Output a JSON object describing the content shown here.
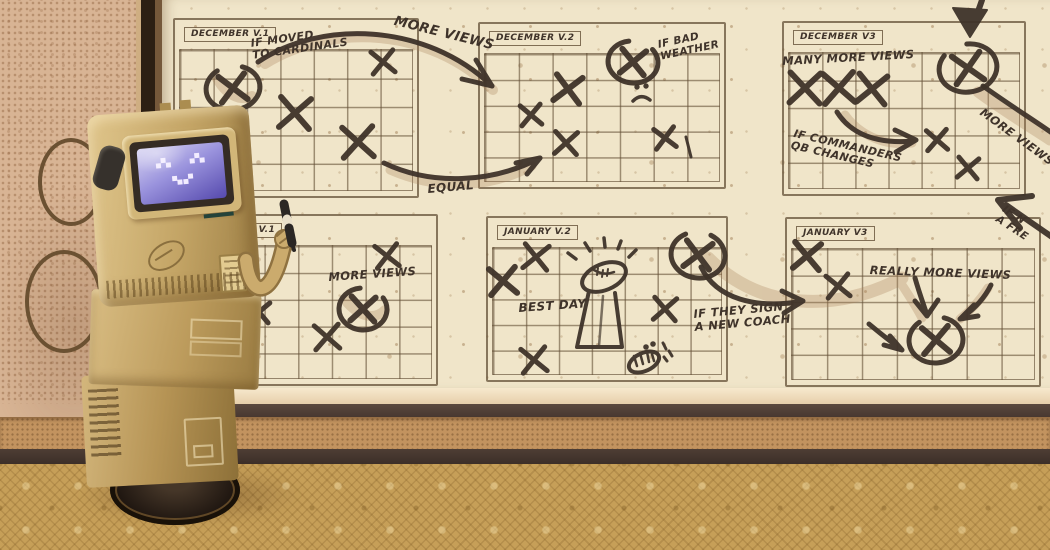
{
  "board": {
    "calendars": [
      {
        "id": "dec-v1",
        "title": "DECEMBER V.1"
      },
      {
        "id": "dec-v2",
        "title": "DECEMBER V.2"
      },
      {
        "id": "dec-v3",
        "title": "DECEMBER V3"
      },
      {
        "id": "jan-v1",
        "title": "JANUARY V.1"
      },
      {
        "id": "jan-v2",
        "title": "JANUARY V.2"
      },
      {
        "id": "jan-v3",
        "title": "JANUARY V3"
      }
    ],
    "annotations": {
      "if_moved": {
        "lines": [
          "IF MOVED",
          "TO CARDINALS"
        ]
      },
      "more_views_top": {
        "lines": [
          "MORE VIEWS"
        ]
      },
      "equal": {
        "lines": [
          "EQUAL"
        ]
      },
      "if_bad_weather": {
        "lines": [
          "IF BAD",
          "WEATHER"
        ]
      },
      "many_more_views": {
        "lines": [
          "MANY MORE VIEWS"
        ]
      },
      "if_commanders": {
        "lines": [
          "IF COMMANDERS",
          "QB CHANGES"
        ]
      },
      "more_views_right_partial": {
        "lines": [
          "MORE VIEWS"
        ]
      },
      "if_free_partial": {
        "lines": [
          "IF N",
          "A FRE"
        ]
      },
      "more_views_jan1": {
        "lines": [
          "MORE VIEWS"
        ]
      },
      "best_day": {
        "lines": [
          "BEST DAY"
        ]
      },
      "if_they_sign": {
        "lines": [
          "IF THEY SIGN",
          "A NEW COACH"
        ]
      },
      "really_more_views": {
        "lines": [
          "REALLY MORE VIEWS"
        ]
      }
    },
    "drawings": [
      "sad-face",
      "football-spotlight",
      "laughing-mouth",
      "x-marks",
      "circled-x-marks",
      "arrows"
    ]
  },
  "marks": {
    "x": [
      {
        "x": 383,
        "y": 62,
        "s": 11,
        "r": -6
      },
      {
        "x": 295,
        "y": 113,
        "s": 15,
        "r": 4
      },
      {
        "x": 358,
        "y": 142,
        "s": 15,
        "r": -3
      },
      {
        "x": 568,
        "y": 89,
        "s": 13,
        "r": 8
      },
      {
        "x": 531,
        "y": 115,
        "s": 10,
        "r": -5
      },
      {
        "x": 566,
        "y": 143,
        "s": 11,
        "r": 3
      },
      {
        "x": 665,
        "y": 138,
        "s": 10,
        "r": -8
      },
      {
        "x": 805,
        "y": 88,
        "s": 15,
        "r": 2
      },
      {
        "x": 839,
        "y": 88,
        "s": 15,
        "r": -4
      },
      {
        "x": 872,
        "y": 89,
        "s": 14,
        "r": 6
      },
      {
        "x": 937,
        "y": 140,
        "s": 10,
        "r": -4
      },
      {
        "x": 968,
        "y": 168,
        "s": 10,
        "r": 5
      },
      {
        "x": 387,
        "y": 256,
        "s": 11,
        "r": -7
      },
      {
        "x": 259,
        "y": 312,
        "s": 10,
        "r": 5
      },
      {
        "x": 327,
        "y": 337,
        "s": 12,
        "r": -4
      },
      {
        "x": 536,
        "y": 257,
        "s": 12,
        "r": 6
      },
      {
        "x": 503,
        "y": 281,
        "s": 13,
        "r": -5
      },
      {
        "x": 665,
        "y": 309,
        "s": 11,
        "r": 4
      },
      {
        "x": 534,
        "y": 360,
        "s": 12,
        "r": -6
      },
      {
        "x": 807,
        "y": 256,
        "s": 13,
        "r": 5
      },
      {
        "x": 838,
        "y": 286,
        "s": 11,
        "r": -6
      }
    ],
    "circled_x": [
      {
        "x": 233,
        "y": 88,
        "s": 13,
        "r": -8,
        "rx": 27,
        "ry": 22
      },
      {
        "x": 633,
        "y": 62,
        "s": 12,
        "r": 6,
        "rx": 25,
        "ry": 21
      },
      {
        "x": 968,
        "y": 68,
        "s": 14,
        "r": -10,
        "rx": 29,
        "ry": 24
      },
      {
        "x": 363,
        "y": 309,
        "s": 12,
        "r": 3,
        "rx": 24,
        "ry": 21
      },
      {
        "x": 698,
        "y": 255,
        "s": 13,
        "r": 8,
        "rx": 27,
        "ry": 23
      },
      {
        "x": 936,
        "y": 340,
        "s": 13,
        "r": -5,
        "rx": 27,
        "ry": 23
      }
    ]
  },
  "colors": {
    "ink": "#3f332a",
    "board": "#f0e5c9",
    "wall": "#d8b494",
    "carpet": "#c69f58",
    "frame": "#2c1f13",
    "robot_body": "#c8aa6e",
    "screen_blue": "#5b4db0"
  }
}
